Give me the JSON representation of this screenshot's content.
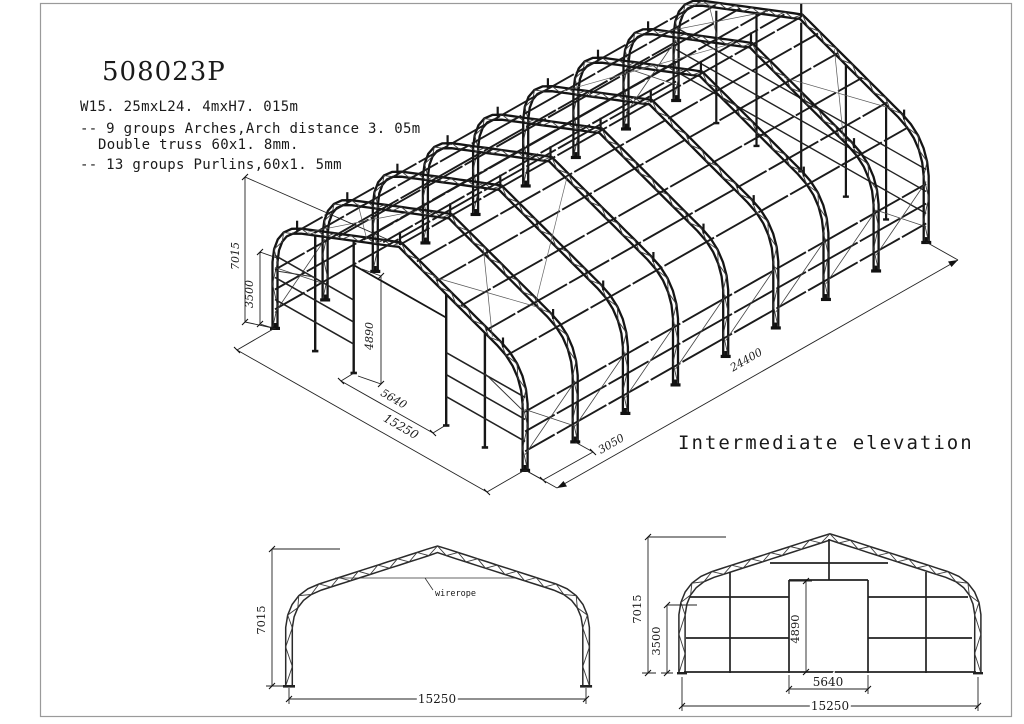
{
  "drawing": {
    "title": "508023P",
    "specs": [
      "W15. 25mxL24. 4mxH7. 015m",
      "-- 9 groups Arches,Arch distance 3. 05m",
      "Double truss 60x1. 8mm.",
      "-- 13 groups Purlins,60x1. 5mm"
    ]
  },
  "iso": {
    "caption": "Intermediate elevation",
    "dim_height": "7015",
    "dim_side": "3500",
    "dim_door_height": "4890",
    "dim_door_width": "5640",
    "dim_span": "15250",
    "dim_bay": "3050",
    "dim_length": "24400"
  },
  "side_view": {
    "dim_height": "7015",
    "dim_span": "15250",
    "wirerope_label": "wirerope"
  },
  "end_view": {
    "dim_height": "7015",
    "dim_side": "3500",
    "dim_door_height": "4890",
    "dim_door_width": "5640",
    "dim_span": "15250"
  }
}
